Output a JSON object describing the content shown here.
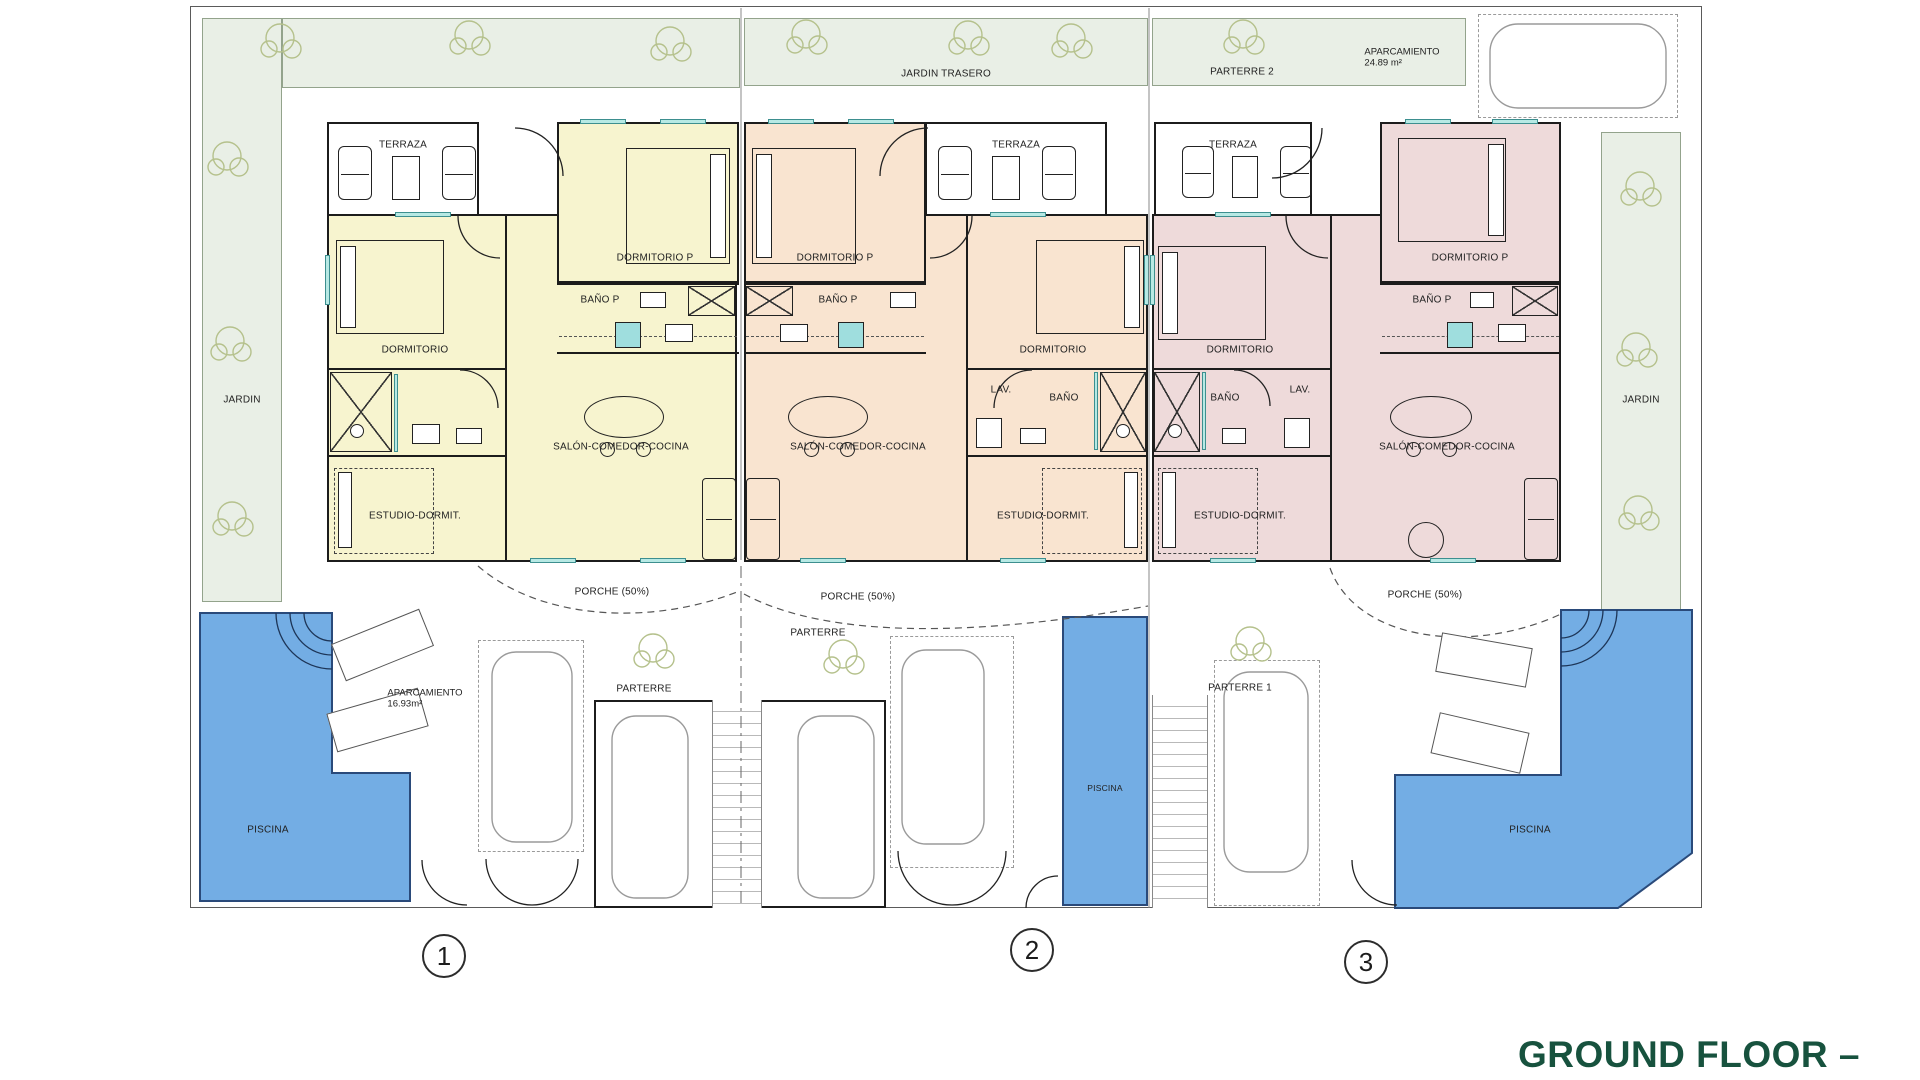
{
  "title": "GROUND FLOOR – PLANTA BAJA",
  "site": {
    "jardin_trasero": "JARDIN TRASERO",
    "parterre_2": "PARTERRE 2",
    "aparcamiento_label": "APARCAMIENTO",
    "aparcamiento_area": "24.89 m²",
    "jardin_left": "JARDIN",
    "jardin_right": "JARDIN"
  },
  "units": [
    {
      "number": "1",
      "terraza": "TERRAZA",
      "dormitorio_p": "DORMITORIO P",
      "bano_p": "BAÑO P",
      "dormitorio": "DORMITORIO",
      "salon": "SALÓN-COMEDOR-COCINA",
      "estudio": "ESTUDIO-DORMIT.",
      "porche": "PORCHE (50%)",
      "parterre": "PARTERRE",
      "aparcamiento_label": "APARCAMIENTO",
      "aparcamiento_area": "16.93m²",
      "piscina": "PISCINA"
    },
    {
      "number": "2",
      "terraza": "TERRAZA",
      "dormitorio_p": "DORMITORIO P",
      "bano_p": "BAÑO P",
      "dormitorio": "DORMITORIO",
      "lav": "LAV.",
      "bano": "BAÑO",
      "salon": "SALÓN-COMEDOR-COCINA",
      "estudio": "ESTUDIO-DORMIT.",
      "porche": "PORCHE (50%)",
      "parterre": "PARTERRE",
      "piscina": "PISCINA"
    },
    {
      "number": "3",
      "terraza": "TERRAZA",
      "dormitorio_p": "DORMITORIO P",
      "bano_p": "BAÑO P",
      "dormitorio": "DORMITORIO",
      "lav": "LAV.",
      "bano": "BAÑO",
      "salon": "SALÓN-COMEDOR-COCINA",
      "estudio": "ESTUDIO-DORMIT.",
      "porche": "PORCHE (50%)",
      "parterre": "PARTERRE 1",
      "piscina": "PISCINA"
    }
  ],
  "colors": {
    "unit1": "#f7f4cf",
    "unit2": "#f9e4d0",
    "unit3": "#eedada",
    "garden": "#e9efe6",
    "pool": "#73ade4",
    "title_green": "#17523e",
    "window": "#b7e9e4"
  }
}
